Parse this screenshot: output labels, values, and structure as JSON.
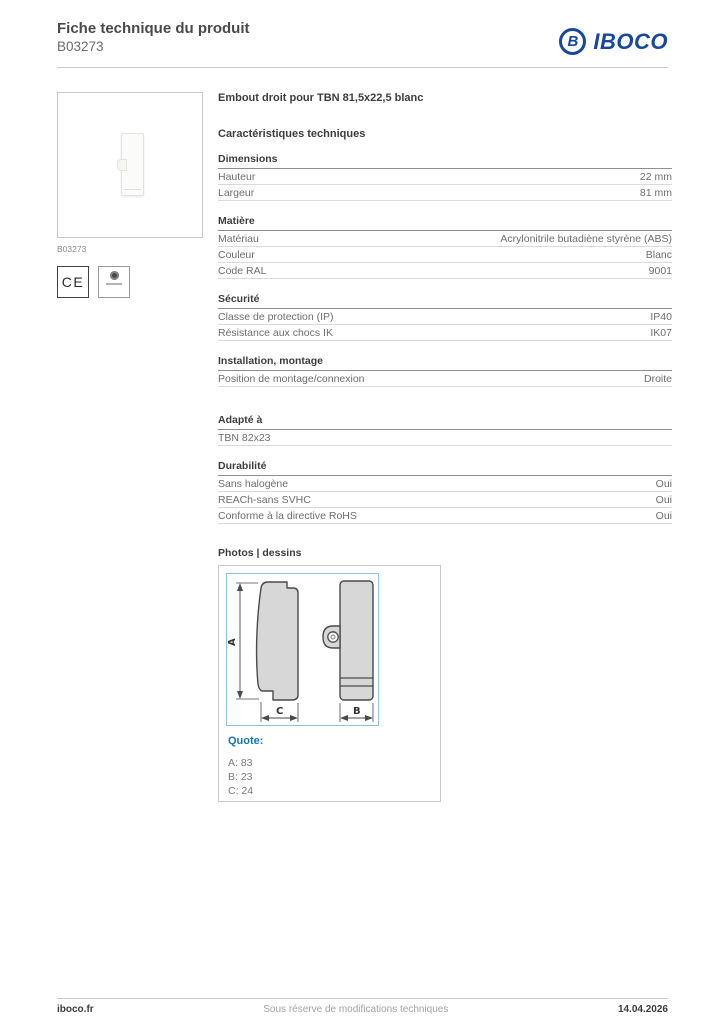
{
  "header": {
    "title": "Fiche technique du produit",
    "product_code": "B03273",
    "brand": "IBOCO",
    "brand_letter": "B",
    "brand_color": "#17489b"
  },
  "left_panel": {
    "image_caption": "B03273",
    "ce_mark": "CE"
  },
  "product": {
    "name": "Embout droit pour TBN 81,5x22,5 blanc"
  },
  "specs": {
    "heading": "Caractéristiques techniques",
    "groups": [
      {
        "title": "Dimensions",
        "rows": [
          {
            "label": "Hauteur",
            "value": "22 mm"
          },
          {
            "label": "Largeur",
            "value": "81 mm"
          }
        ]
      },
      {
        "title": "Matière",
        "rows": [
          {
            "label": "Matériau",
            "value": "Acrylonitrile butadiène styrène (ABS)"
          },
          {
            "label": "Couleur",
            "value": "Blanc"
          },
          {
            "label": "Code RAL",
            "value": "9001"
          }
        ]
      },
      {
        "title": "Sécurité",
        "rows": [
          {
            "label": "Classe de protection (IP)",
            "value": "IP40"
          },
          {
            "label": "Résistance aux chocs IK",
            "value": "IK07"
          }
        ]
      },
      {
        "title": "Installation, montage",
        "rows": [
          {
            "label": "Position de montage/connexion",
            "value": "Droite"
          }
        ]
      },
      {
        "title": "Adapté à",
        "rows": [
          {
            "label": "TBN 82x23",
            "value": ""
          }
        ]
      },
      {
        "title": "Durabilité",
        "rows": [
          {
            "label": "Sans halogène",
            "value": "Oui"
          },
          {
            "label": "REACh-sans SVHC",
            "value": "Oui"
          },
          {
            "label": "Conforme à la directive RoHS",
            "value": "Oui"
          }
        ]
      }
    ]
  },
  "photos": {
    "heading": "Photos | dessins",
    "quote_label": "Quote:",
    "quote_lines": [
      "A: 83",
      "B: 23",
      "C: 24"
    ],
    "drawing": {
      "label_a": "A",
      "label_b": "B",
      "label_c": "C"
    }
  },
  "footer": {
    "site": "iboco.fr",
    "notice": "Sous réserve de modifications techniques",
    "date": "14.04.2026"
  }
}
